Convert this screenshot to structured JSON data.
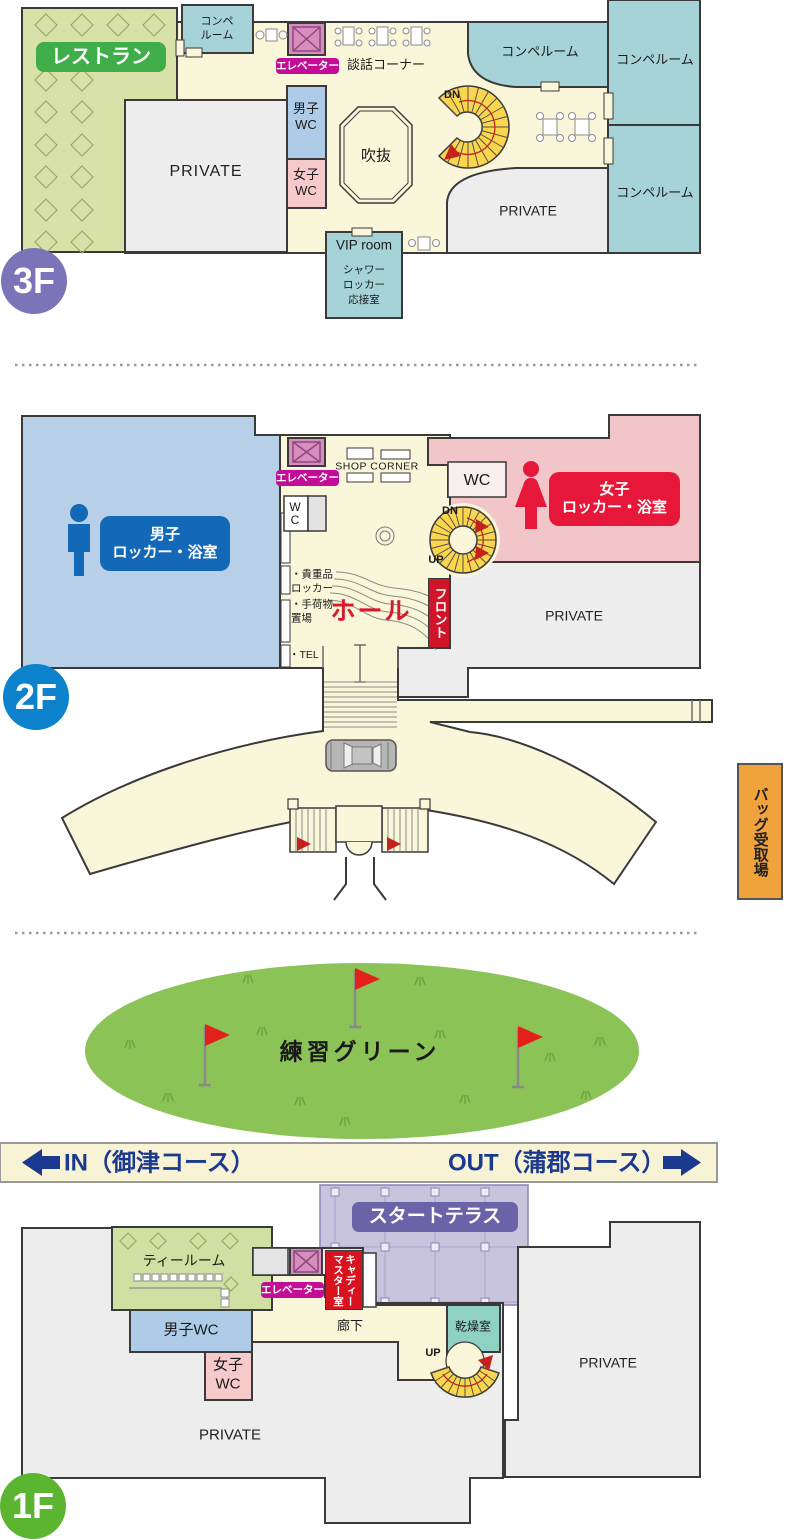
{
  "f3": {
    "badge": "3F",
    "restaurant": "レストラン",
    "compe_small": "コンペ\nルーム",
    "elevator": "エレベーター",
    "chat_corner": "談話コーナー",
    "male_wc": "男子\nWC",
    "female_wc": "女子\nWC",
    "private_left": "PRIVATE",
    "atrium": "吹抜",
    "dn": "DN",
    "compe_mid": "コンペルーム",
    "compe_right_top": "コンペルーム",
    "compe_right_bottom": "コンペルーム",
    "private_right": "PRIVATE",
    "vip_room": "VIP room",
    "vip_services": "シャワー\nロッカー\n応接室"
  },
  "f2": {
    "badge": "2F",
    "male_locker": "男子\nロッカー・浴室",
    "elevator": "エレベーター",
    "shop_corner": "SHOP CORNER",
    "wc_left": "W\nC",
    "wc_right": "WC",
    "female_locker": "女子\nロッカー・浴室",
    "dn": "DN",
    "up": "UP",
    "front": "フロント",
    "hall": "ホール",
    "valuables": "・貴重品\n ロッカー",
    "luggage": "・手荷物\n 置場",
    "tel": "・TEL",
    "private": "PRIVATE",
    "bag_pickup": "バッグ受取場"
  },
  "practice": {
    "green": "練習グリーン",
    "in_course": "IN（御津コース）",
    "out_course": "OUT（蒲郡コース）"
  },
  "f1": {
    "badge": "1F",
    "tea_room": "ティールーム",
    "elevator": "エレベーター",
    "caddie_master": "キャディー\nマスター室",
    "start_terrace": "スタートテラス",
    "male_wc": "男子WC",
    "female_wc": "女子\nWC",
    "corridor": "廊下",
    "drying_room": "乾燥室",
    "up": "UP",
    "private_right": "PRIVATE",
    "private_main": "PRIVATE"
  },
  "colors": {
    "floor_cream": "#FAF6DA",
    "band_cream": "#F8F3D4",
    "restaurant_area": "#D8E2A8",
    "compe_teal": "#A5D3D8",
    "drying_teal": "#8FD2C3",
    "private_gray": "#EDEDEE",
    "male_wc_blue": "#AECCE8",
    "female_wc_pink": "#F6CACA",
    "male_zone_blue": "#B8CFE8",
    "female_zone_pink": "#F2C6C9",
    "stairs_yellow": "#FAD64F",
    "elevator_shaft": "#D98CC0",
    "elevator_label": "#C40D96",
    "restaurant_label": "#3FAE49",
    "male_label": "#1468B8",
    "female_label": "#E61739",
    "front_label": "#D01528",
    "caddie_label": "#D8131F",
    "hall_text": "#D7182D",
    "terrace": "#C9C4DE",
    "terrace_label": "#6B62A8",
    "practice_green": "#8CC356",
    "course_text": "#1B3A8F",
    "bag_pickup": "#F0A23C",
    "badge_3f": "#7B74B8",
    "badge_2f": "#0B82CB",
    "badge_1f": "#5CB531",
    "wall": "#3A3A3A"
  }
}
